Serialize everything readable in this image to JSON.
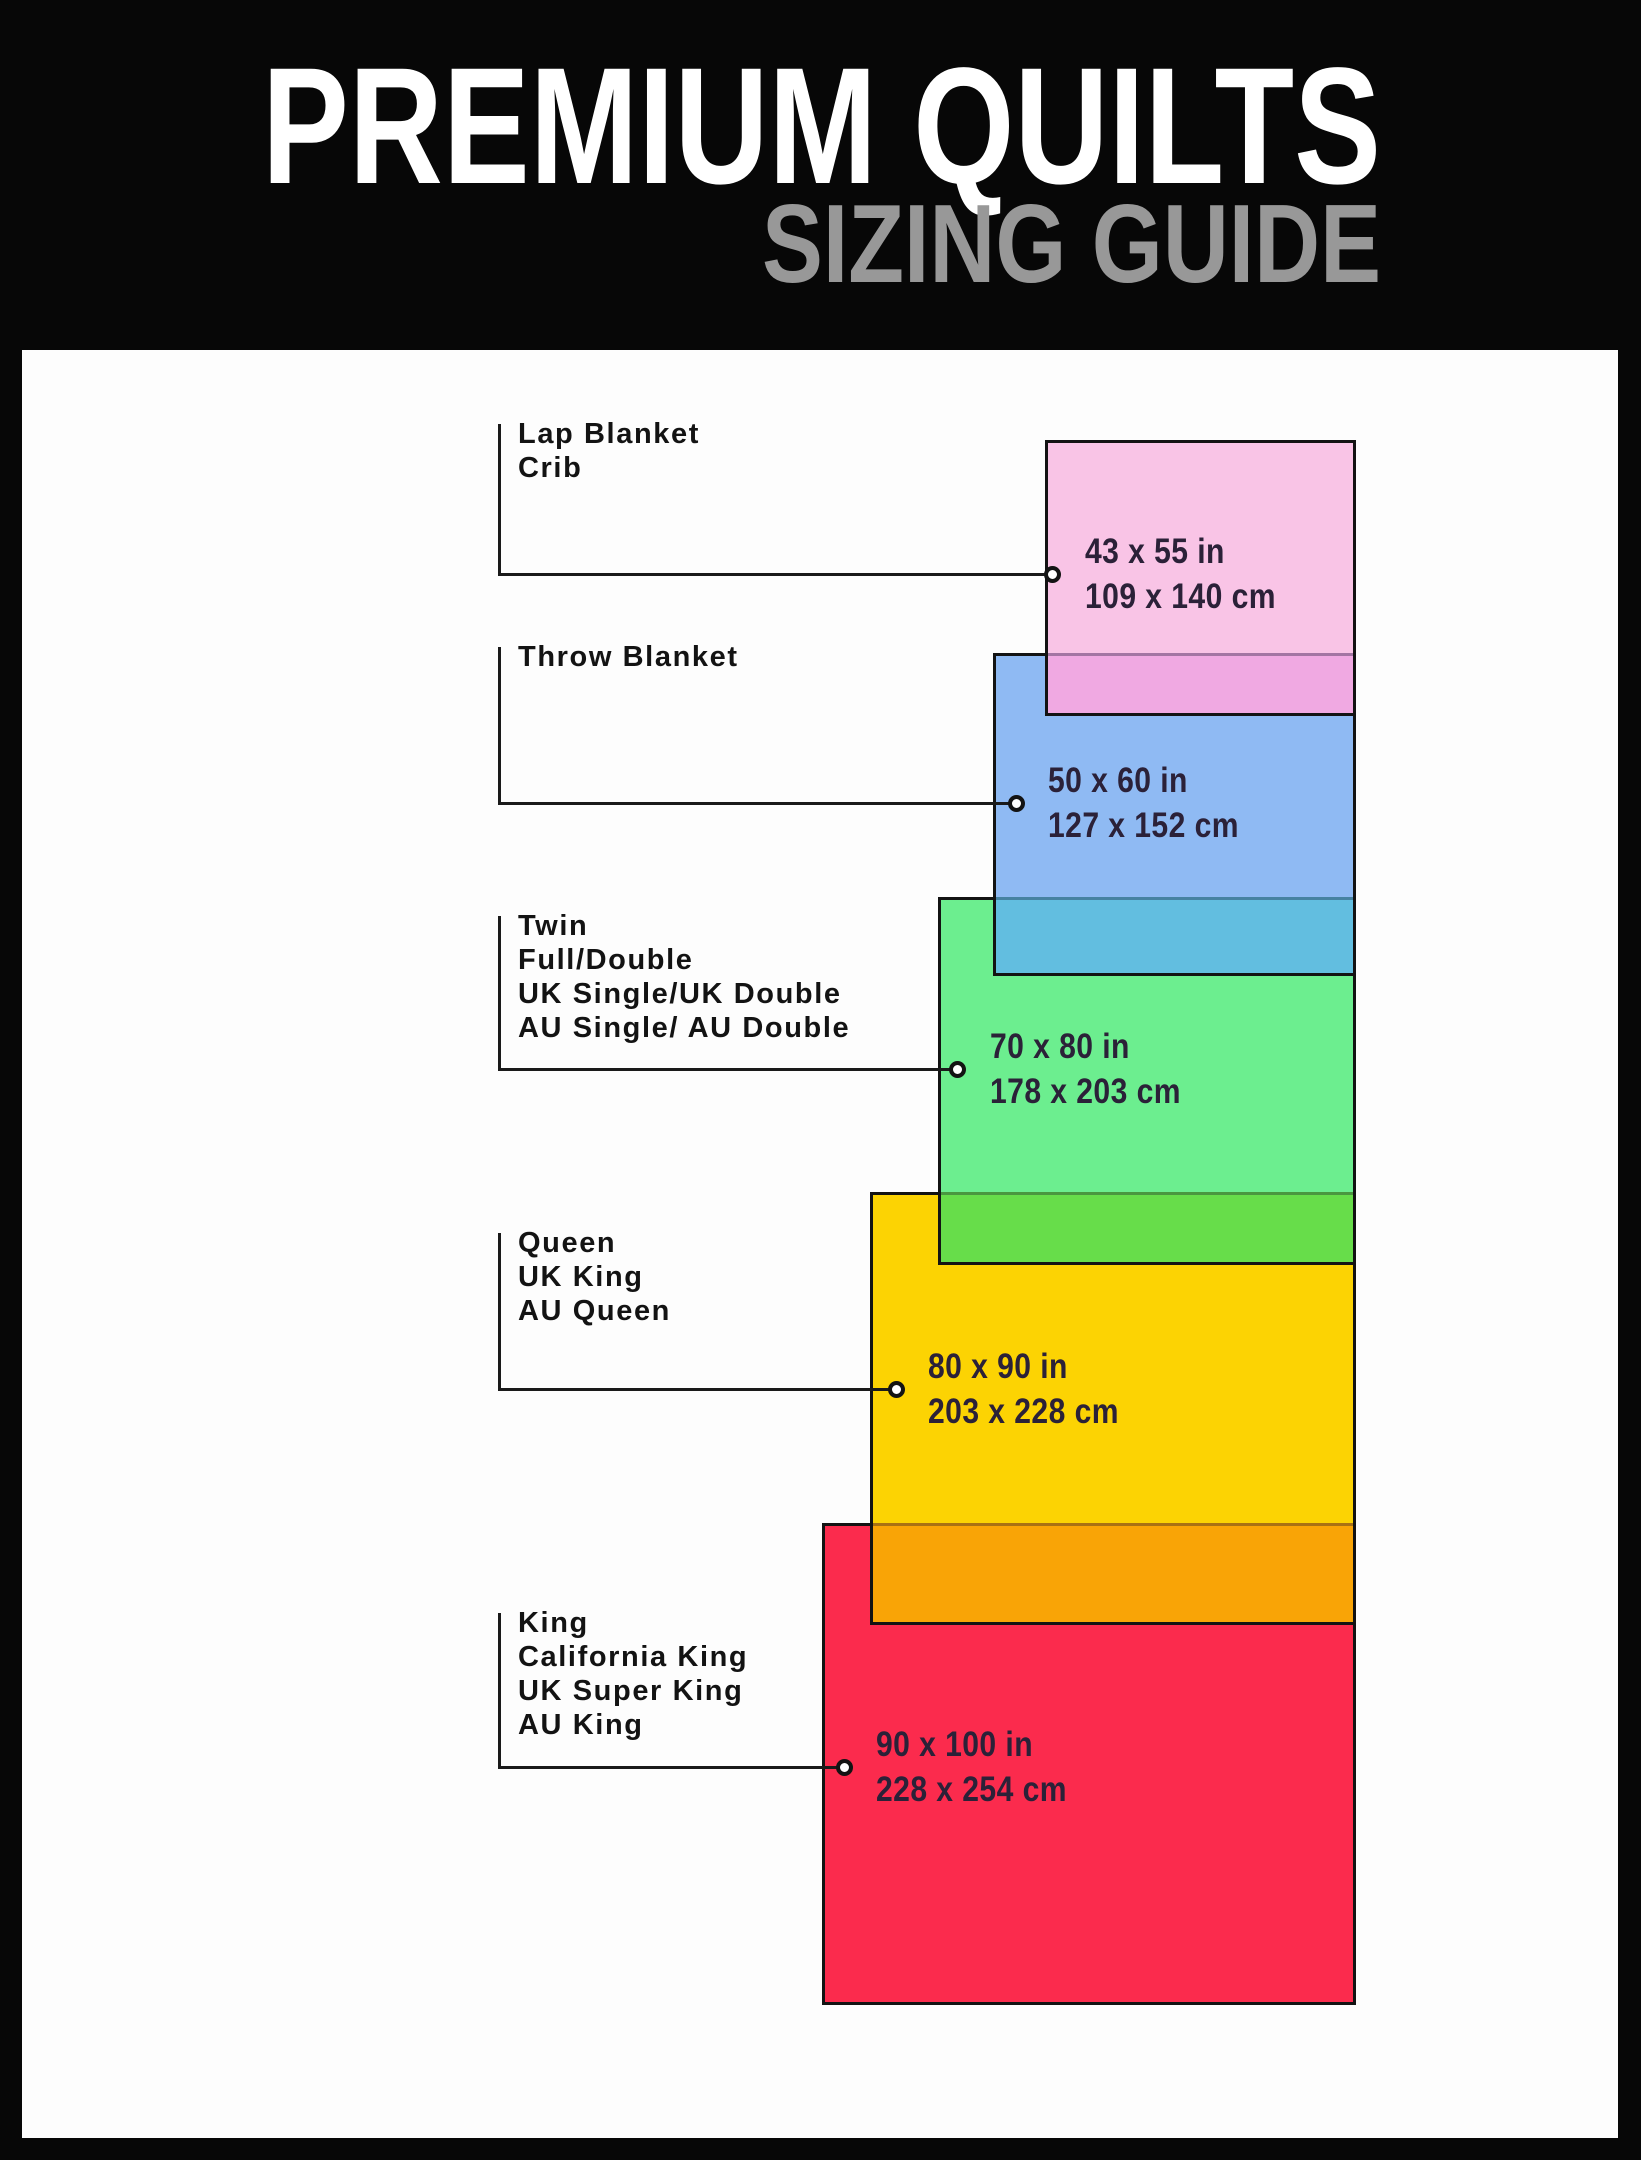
{
  "header": {
    "title": "PREMIUM QUILTS",
    "subtitle": "SIZING GUIDE"
  },
  "palette": {
    "header_bg": "#070707",
    "panel_bg": "#fdfdfd",
    "line_color": "#1a1a1a",
    "title_color": "#ffffff",
    "subtitle_color": "#989898",
    "size_text_color": "#2b2138"
  },
  "sizes": [
    {
      "id": "lap-blanket",
      "labels": [
        "Lap Blanket",
        "Crib"
      ],
      "inches": "43 x 55 in",
      "cm": "109 x 140 cm",
      "fill": "#f9c4e6",
      "overlap_fill": "#f0a9e2"
    },
    {
      "id": "throw-blanket",
      "labels": [
        "Throw Blanket"
      ],
      "inches": "50 x 60 in",
      "cm": "127 x 152 cm",
      "fill": "#8fbaf3",
      "overlap_fill": "#62bee0"
    },
    {
      "id": "twin",
      "labels": [
        "Twin",
        "Full/Double",
        "UK Single/UK Double",
        "AU Single/ AU Double"
      ],
      "inches": "70 x 80 in",
      "cm": "178 x 203 cm",
      "fill": "#6cee8f",
      "overlap_fill": "#67dd4a"
    },
    {
      "id": "queen",
      "labels": [
        "Queen",
        "UK King",
        "AU Queen"
      ],
      "inches": "80 x 90 in",
      "cm": "203 x 228 cm",
      "fill": "#fcd303",
      "overlap_fill": "#f9a406"
    },
    {
      "id": "king",
      "labels": [
        "King",
        "California King",
        "UK Super King",
        "AU King"
      ],
      "inches": "90 x 100 in",
      "cm": "228 x 254 cm",
      "fill": "#fb2b4d",
      "overlap_fill": null
    }
  ]
}
